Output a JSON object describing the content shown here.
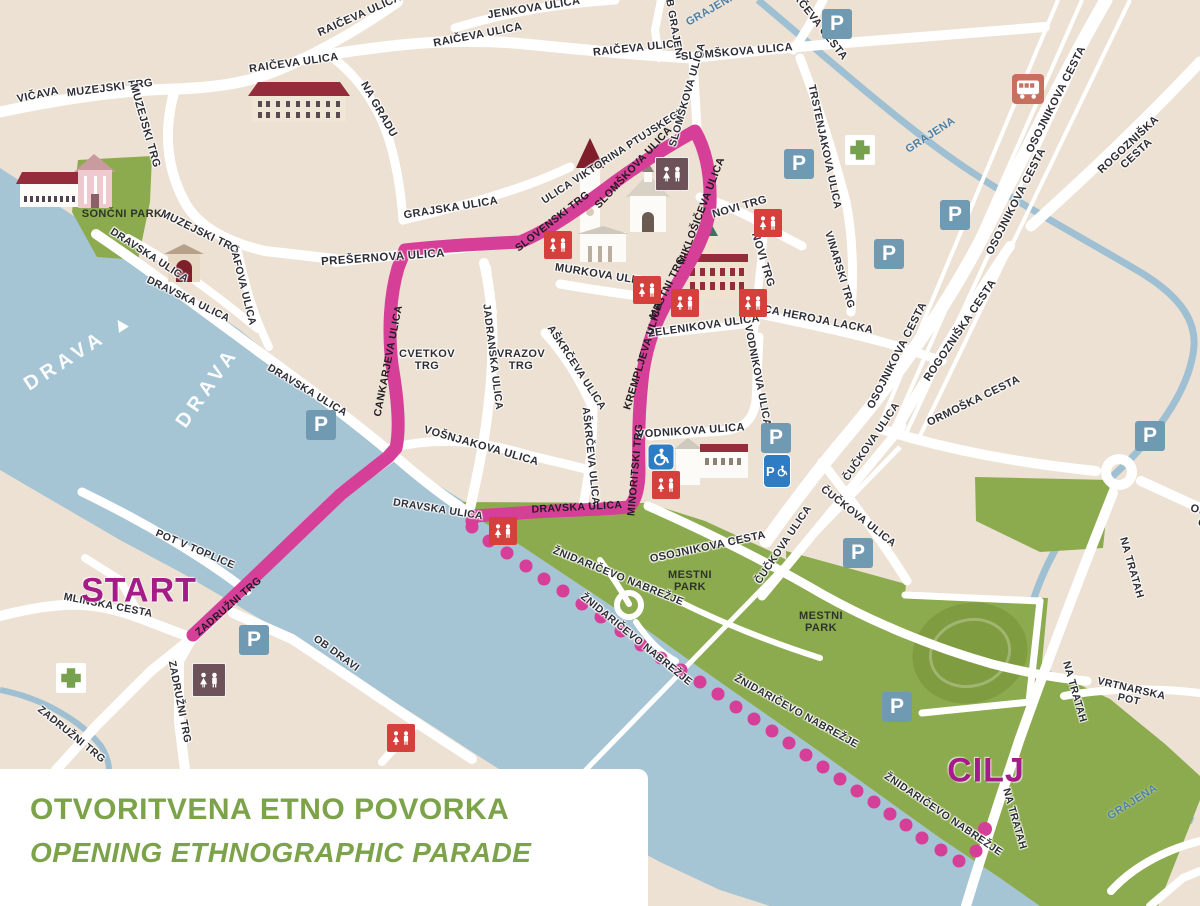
{
  "title": {
    "line1": "OTVORITVENA ETNO POVORKA",
    "line2": "OPENING ETHNOGRAPHIC PARADE"
  },
  "route": {
    "start_label": "START",
    "finish_label": "CILJ"
  },
  "icons": {
    "parking_letter": "P",
    "parking_icon": "parking-icon",
    "toilet_icon": "toilets-icon",
    "pharmacy_icon": "pharmacy-cross-icon",
    "bus_icon": "bus-station-icon",
    "accessible_icon": "wheelchair-icon",
    "accessible_parking_icon": "accessible-parking-icon"
  },
  "colors": {
    "route_pink": "#d63f97",
    "start_finish_text": "#a31c87",
    "title_green": "#7ca34a",
    "park_green": "#8cab4e",
    "river_blue": "#a5c4d4",
    "land_beige": "#ece1d3",
    "parking_blue": "#6f9ab2",
    "toilet_red": "#d5403c",
    "toilet_mauve": "#6e525a",
    "accessible_blue": "#2e7cc3",
    "bus_salmon": "#c8705f",
    "roof_red": "#942c3b"
  },
  "map": {
    "labels": [
      {
        "text": "VIČAVA",
        "kind": "st"
      },
      {
        "text": "MUZEJSKI TRG",
        "kind": "st"
      },
      {
        "text": "MUZEJSKI TRG",
        "kind": "st"
      },
      {
        "text": "MUZEJSKI TRG",
        "kind": "st"
      },
      {
        "text": "RAIČEVA ULICA",
        "kind": "st"
      },
      {
        "text": "RAIČEVA ULICA",
        "kind": "st"
      },
      {
        "text": "RAIČEVA ULICA",
        "kind": "st"
      },
      {
        "text": "RAIČEVA ULICA",
        "kind": "st"
      },
      {
        "text": "JENKOVA ULICA",
        "kind": "st"
      },
      {
        "text": "NA GRADU",
        "kind": "st"
      },
      {
        "text": "OB GRAJENI",
        "kind": "st"
      },
      {
        "text": "SLOMŠKOVA ULICA",
        "kind": "st"
      },
      {
        "text": "POTRČEVA CESTA",
        "kind": "st"
      },
      {
        "text": "GRAJENA",
        "kind": "bl"
      },
      {
        "text": "GRAJENA",
        "kind": "bl"
      },
      {
        "text": "GRAJENA",
        "kind": "bl"
      },
      {
        "text": "TRSTENJAKOVA ULICA",
        "kind": "st"
      },
      {
        "text": "VINARSKI TRG",
        "kind": "st"
      },
      {
        "text": "OSOJNIKOVA CESTA",
        "kind": "st"
      },
      {
        "text": "OSOJNIKOVA CESTA",
        "kind": "st"
      },
      {
        "text": "OSOJNIKOVA CESTA",
        "kind": "st"
      },
      {
        "text": "OSOJNIKOVA CESTA",
        "kind": "st"
      },
      {
        "text": "ROGOZNIŠKA CESTA",
        "kind": "st"
      },
      {
        "text": "ROGOZNIŠKA CESTA",
        "kind": "st"
      },
      {
        "text": "ORMOŠKA CESTA",
        "kind": "st"
      },
      {
        "text": "ORMOŠKA CESTA",
        "kind": "st"
      },
      {
        "text": "GRAJSKA ULICA",
        "kind": "st"
      },
      {
        "text": "PREŠERNOVA ULICA",
        "kind": "st"
      },
      {
        "text": "ULICA VIKTORINA PTUJSKEGA",
        "kind": "st"
      },
      {
        "text": "MURKOVA ULICA",
        "kind": "st"
      },
      {
        "text": "NOVI TRG",
        "kind": "st"
      },
      {
        "text": "NOVI TRG",
        "kind": "st"
      },
      {
        "text": "ZELENIKOVA ULICA",
        "kind": "st"
      },
      {
        "text": "ULICA HEROJA LACKA",
        "kind": "st"
      },
      {
        "text": "CVETKOV\nTRG",
        "kind": "st"
      },
      {
        "text": "JADRANSKA ULICA",
        "kind": "st"
      },
      {
        "text": "VRAZOV\nTRG",
        "kind": "st"
      },
      {
        "text": "AŠKRČEVA ULICA",
        "kind": "st"
      },
      {
        "text": "AŠKRČEVA ULICA",
        "kind": "st"
      },
      {
        "text": "VOŠNJAKOVA ULICA",
        "kind": "st"
      },
      {
        "text": "VODNIKOVA ULICA",
        "kind": "st"
      },
      {
        "text": "VODNIKOVA ULICA",
        "kind": "st"
      },
      {
        "text": "DRAVSKA ULICA",
        "kind": "st"
      },
      {
        "text": "DRAVSKA ULICA",
        "kind": "st"
      },
      {
        "text": "DRAVSKA ULICA",
        "kind": "st"
      },
      {
        "text": "DRAVSKA ULICA",
        "kind": "st"
      },
      {
        "text": "CAFOVA ULICA",
        "kind": "st"
      },
      {
        "text": "POT V TOPLICE",
        "kind": "st"
      },
      {
        "text": "MLINSKA CESTA",
        "kind": "st"
      },
      {
        "text": "ZADRUŽNI TRG",
        "kind": "st"
      },
      {
        "text": "ZADRUŽNI TRG",
        "kind": "st"
      },
      {
        "text": "OB DRAVI",
        "kind": "st"
      },
      {
        "text": "ŽNIDARIČEVO NABREŽJE",
        "kind": "st"
      },
      {
        "text": "ŽNIDARIČEVO NABREŽJE",
        "kind": "st"
      },
      {
        "text": "ŽNIDARIČEVO NABREŽJE",
        "kind": "st"
      },
      {
        "text": "ŽNIDARIČEVO NABREŽJE",
        "kind": "st"
      },
      {
        "text": "MESTNI\nPARK",
        "kind": "pk"
      },
      {
        "text": "MESTNI\nPARK",
        "kind": "pk"
      },
      {
        "text": "ČUČKOVA ULICA",
        "kind": "st"
      },
      {
        "text": "ČUČKOVA ULICA",
        "kind": "st"
      },
      {
        "text": "ČUČKOVA ULICA",
        "kind": "st"
      },
      {
        "text": "NA TRATAH",
        "kind": "st"
      },
      {
        "text": "NA TRATAH",
        "kind": "st"
      },
      {
        "text": "NA TRATAH",
        "kind": "st"
      },
      {
        "text": "VRTNARSKA POT",
        "kind": "st"
      },
      {
        "text": "SONČNI PARK",
        "kind": "pk"
      },
      {
        "text": "DRAVA ▲",
        "kind": "wt"
      },
      {
        "text": "DRAVA",
        "kind": "wt"
      },
      {
        "text": "CANKARJEVA ULICA",
        "kind": "rt"
      },
      {
        "text": "SLOVENSKI TRG",
        "kind": "rt"
      },
      {
        "text": "SLOMŠKOVA ULICA",
        "kind": "rt"
      },
      {
        "text": "SLOMŠKOVA ULICA",
        "kind": "st"
      },
      {
        "text": "MIKLOŠIČEVA ULICA",
        "kind": "rt"
      },
      {
        "text": "MESTNI TRG",
        "kind": "rt"
      },
      {
        "text": "KREMPLJEVA ULICA",
        "kind": "rt"
      },
      {
        "text": "MINORITSKI TRG",
        "kind": "rt"
      },
      {
        "text": "DRAVSKA ULICA",
        "kind": "rt"
      },
      {
        "text": "ZADRUŽNI TRG",
        "kind": "rt"
      },
      {
        "text": "START",
        "kind": "big"
      },
      {
        "text": "CILJ",
        "kind": "big"
      }
    ]
  }
}
